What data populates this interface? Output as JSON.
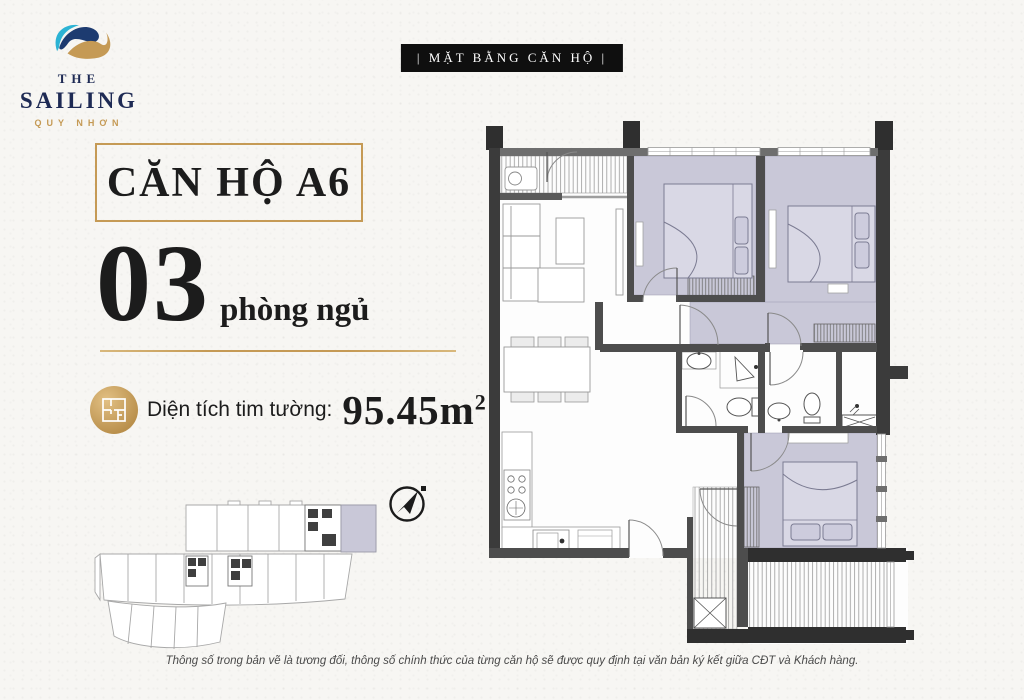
{
  "poster": {
    "badge": "| MẶT BẰNG CĂN HỘ |",
    "disclaimer": "Thông số trong bản vẽ là tương đối, thông số chính thức của từng căn hộ sẽ được quy định tại văn bản ký kết giữa CĐT và Khách hàng."
  },
  "logo": {
    "word1": "THE",
    "word2": "SAILING",
    "word3": "QUY NHƠN"
  },
  "unit": {
    "title": "CĂN HỘ A6",
    "bedrooms_count": "03",
    "bedrooms_label": "phòng ngủ",
    "area_label": "Diện tích tim tường:",
    "area_value": "95.45m",
    "area_superscript": "2"
  },
  "colors": {
    "navy": "#1e2a54",
    "gold": "#c59a55",
    "badge_bg": "#0f0f0f",
    "paper": "#f7f6f3",
    "room_highlight": "#c9c8d8",
    "wall": "#3b3b3b"
  },
  "icons": [
    "wave-logo-icon",
    "floor-plan-icon",
    "north-arrow-icon"
  ]
}
